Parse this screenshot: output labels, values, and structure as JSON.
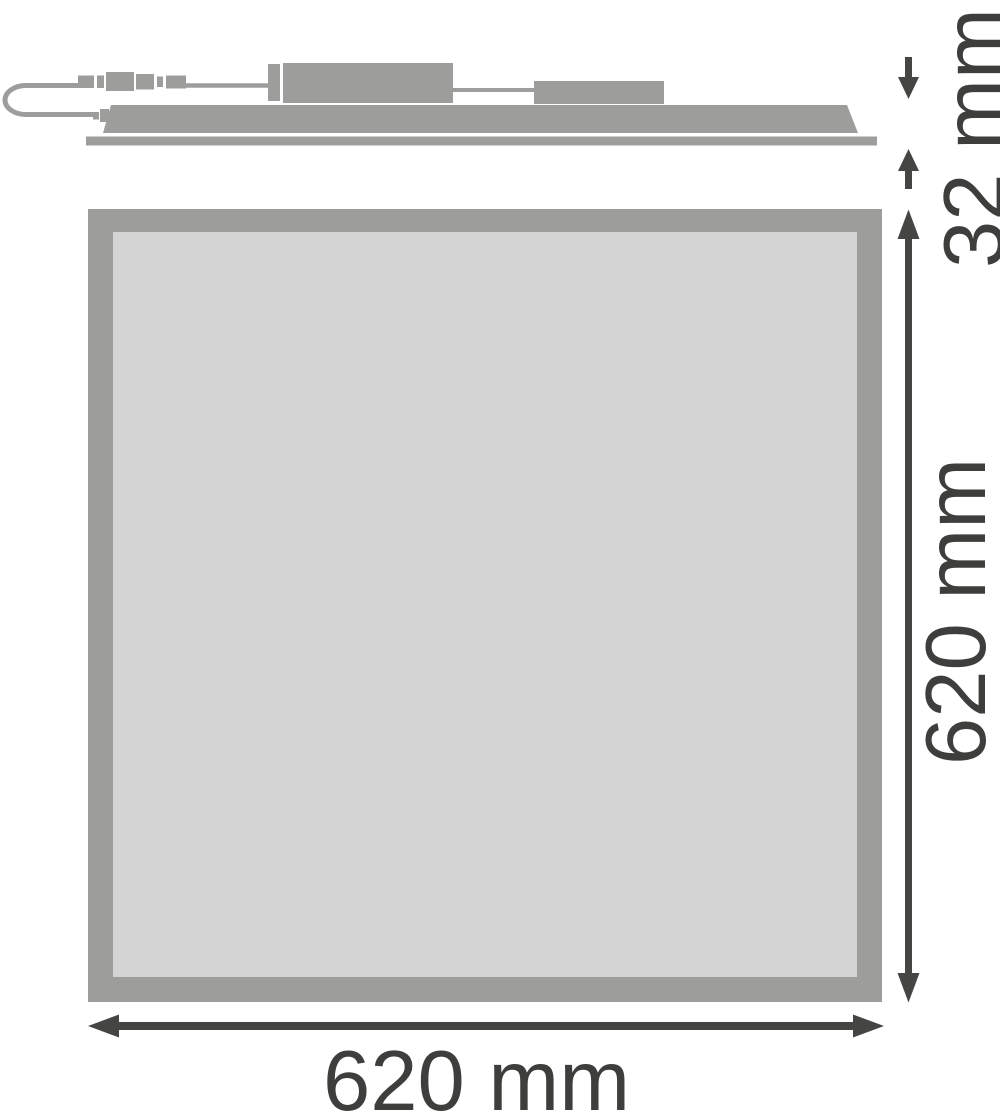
{
  "drawing": {
    "type": "product-dimension-drawing",
    "views": {
      "side_view": {
        "parts": [
          "cable-loop",
          "plug-connector",
          "driver-box",
          "secondary-box",
          "panel-profile",
          "panel-flange"
        ]
      },
      "front_view": {
        "parts": [
          "panel-frame",
          "panel-face"
        ]
      }
    },
    "dimensions": {
      "thickness": {
        "value": "32",
        "unit": "mm",
        "label": "32 mm"
      },
      "height": {
        "value": "620",
        "unit": "mm",
        "label": "620 mm"
      },
      "width": {
        "value": "620",
        "unit": "mm",
        "label": "620 mm"
      }
    }
  },
  "colors": {
    "part_gray": "#9d9d9c",
    "panel_face": "#d4d4d4",
    "dim_color": "#454543",
    "text_color": "#3e3e3c",
    "background": "#ffffff"
  }
}
